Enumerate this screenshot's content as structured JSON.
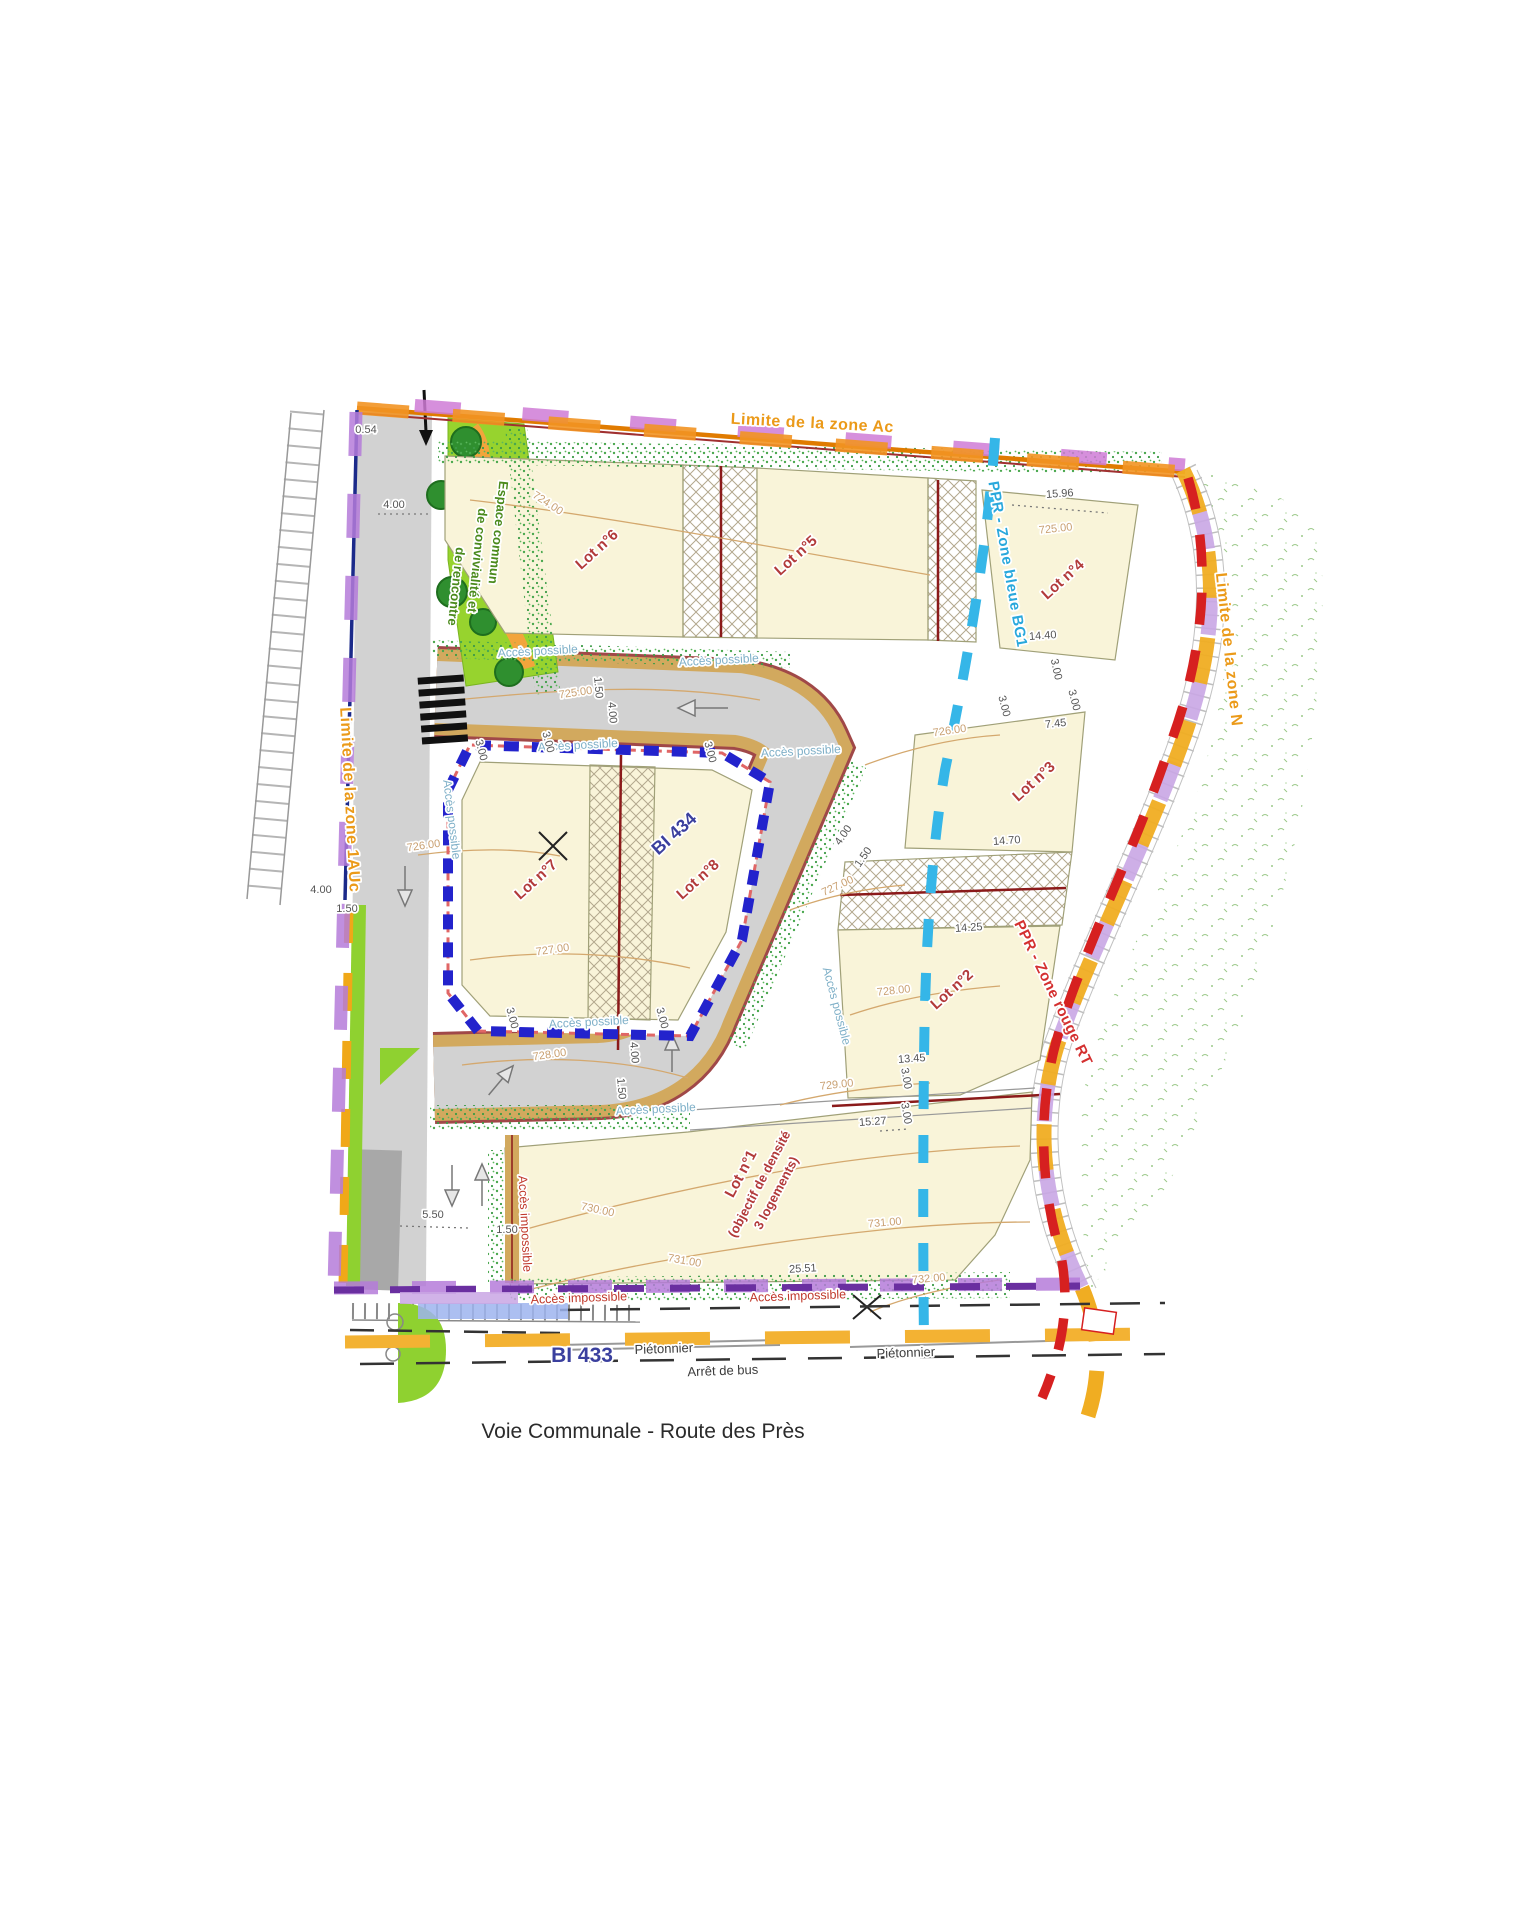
{
  "title": "Voie Communale - Route des Près",
  "colors": {
    "zone_ac_orange": "#f08c00",
    "zone_violet": "#cf7bd6",
    "zone_n_gold": "#f0ad22",
    "zone_lavender": "#c9a6e4",
    "ppr_blue": "#35b6e8",
    "ppr_red": "#d62020",
    "bi434_blue": "#2323cc",
    "lot_fill": "#f9f4d9",
    "road_gray": "#d2d2d2",
    "road_edge_tan": "#d2a95e",
    "green_space": "#97d32e"
  },
  "labels": {
    "groups": [
      {
        "name": "zone-boundaries",
        "cls": "lbl-zone",
        "size": 16,
        "color": "#eb9a19",
        "items": [
          {
            "id": "zone-ac-label",
            "t": "Limite de la zone Ac",
            "x": 812,
            "y": 428,
            "r": 3
          },
          {
            "id": "zone-n-label",
            "t": "Limite de la zone N",
            "x": 1224,
            "y": 650,
            "r": 84
          },
          {
            "id": "zone-1auc-label",
            "t": "Limite de la zone 1AUc",
            "x": 345,
            "y": 800,
            "r": 87
          }
        ]
      },
      {
        "name": "ppr-zones",
        "cls": "lbl-zone",
        "size": 15,
        "color": "#29a8dc",
        "items": [
          {
            "id": "ppr-bleue-label",
            "t": "PPR - Zone bleue BG1",
            "x": 1003,
            "y": 565,
            "r": 80
          }
        ]
      },
      {
        "name": "ppr-zones-red",
        "cls": "lbl-zone",
        "size": 15,
        "color": "#d43030",
        "items": [
          {
            "id": "ppr-rouge-label",
            "t": "PPR - Zone rouge RT",
            "x": 1049,
            "y": 995,
            "r": 64
          }
        ]
      },
      {
        "name": "lot-labels",
        "cls": "lbl-lot",
        "size": 15,
        "color": "#b23a3a",
        "items": [
          {
            "id": "lot-6",
            "t": "Lot n°6",
            "x": 600,
            "y": 553,
            "r": -42
          },
          {
            "id": "lot-5",
            "t": "Lot n°5",
            "x": 799,
            "y": 559,
            "r": -42
          },
          {
            "id": "lot-4",
            "t": "Lot n°4",
            "x": 1066,
            "y": 583,
            "r": -42
          },
          {
            "id": "lot-3",
            "t": "Lot n°3",
            "x": 1037,
            "y": 785,
            "r": -42
          },
          {
            "id": "lot-2",
            "t": "Lot n°2",
            "x": 955,
            "y": 993,
            "r": -42
          },
          {
            "id": "lot-7",
            "t": "Lot n°7",
            "x": 539,
            "y": 883,
            "r": -42
          },
          {
            "id": "lot-8",
            "t": "Lot n°8",
            "x": 701,
            "y": 883,
            "r": -42
          },
          {
            "id": "lot-1",
            "t": "Lot n°1",
            "x": 745,
            "y": 1176,
            "r": -62
          }
        ]
      },
      {
        "name": "lot-1-note",
        "cls": "lbl-lot",
        "size": 13,
        "color": "#b23a3a",
        "items": [
          {
            "id": "lot-1-note-line1",
            "t": "(objectif de densité",
            "x": 763,
            "y": 1186,
            "r": -62
          },
          {
            "id": "lot-1-note-line2",
            "t": "3 logements)",
            "x": 780,
            "y": 1195,
            "r": -62
          }
        ]
      },
      {
        "name": "bi-parcels",
        "cls": "lbl-bi",
        "size": 18,
        "color": "#3a3f9e",
        "items": [
          {
            "id": "bi-434",
            "t": "BI 434",
            "x": 678,
            "y": 838,
            "r": -42
          }
        ]
      },
      {
        "name": "bi-433-parcel",
        "cls": "lbl-bi",
        "size": 21,
        "color": "#3a3f9e",
        "items": [
          {
            "id": "bi-433",
            "t": "BI 433",
            "x": 582,
            "y": 1362,
            "r": 0
          }
        ]
      },
      {
        "name": "access-possible",
        "cls": "lbl-acc",
        "size": 12,
        "color": "#7fb0c8",
        "items": [
          {
            "id": "acces-possible-1",
            "t": "Accès possible",
            "x": 538,
            "y": 655,
            "r": -3
          },
          {
            "id": "acces-possible-2",
            "t": "Accès possible",
            "x": 719,
            "y": 664,
            "r": -3
          },
          {
            "id": "acces-possible-3",
            "t": "Accès possible",
            "x": 578,
            "y": 749,
            "r": -3
          },
          {
            "id": "acces-possible-4",
            "t": "Accès possible",
            "x": 801,
            "y": 755,
            "r": -3
          },
          {
            "id": "acces-possible-5",
            "t": "Accès possible",
            "x": 448,
            "y": 820,
            "r": 83
          },
          {
            "id": "acces-possible-6",
            "t": "Accès possible",
            "x": 589,
            "y": 1026,
            "r": -3
          },
          {
            "id": "acces-possible-7",
            "t": "Accès possible",
            "x": 656,
            "y": 1113,
            "r": -3
          },
          {
            "id": "acces-possible-8",
            "t": "Accès possible",
            "x": 833,
            "y": 1007,
            "r": 75
          }
        ]
      },
      {
        "name": "access-impossible",
        "cls": "lbl-acc",
        "size": 12.5,
        "color": "#c0392b",
        "items": [
          {
            "id": "acces-impossible-1",
            "t": "Accès impossible",
            "x": 521,
            "y": 1224,
            "r": 87
          },
          {
            "id": "acces-impossible-2",
            "t": "Accès impossible",
            "x": 579,
            "y": 1302,
            "r": -2
          },
          {
            "id": "acces-impossible-3",
            "t": "Accès impossible",
            "x": 798,
            "y": 1300,
            "r": -2
          }
        ]
      },
      {
        "name": "green-space-label",
        "cls": "lbl-esp",
        "size": 13,
        "color": "#4a8a1c",
        "items": [
          {
            "id": "espace-commun-line1",
            "t": "Espace commun",
            "x": 494,
            "y": 532,
            "r": 96
          },
          {
            "id": "espace-commun-line2",
            "t": "de convivialité et",
            "x": 473,
            "y": 560,
            "r": 96
          },
          {
            "id": "espace-commun-line3",
            "t": "de rencontre",
            "x": 452,
            "y": 586,
            "r": 96
          }
        ]
      },
      {
        "name": "street-labels",
        "cls": "lbl-street",
        "size": 13,
        "color": "#3c3c3c",
        "items": [
          {
            "id": "pietonnier-left",
            "t": "Piétonnier",
            "x": 664,
            "y": 1353,
            "r": -2
          },
          {
            "id": "pietonnier-right",
            "t": "Piétonnier",
            "x": 906,
            "y": 1357,
            "r": -2
          },
          {
            "id": "arret-de-bus",
            "t": "Arrêt de bus",
            "x": 723,
            "y": 1375,
            "r": -2
          }
        ]
      },
      {
        "name": "dimensions",
        "cls": "lbl-dim",
        "size": 11,
        "color": "#555555",
        "items": [
          {
            "id": "dim-0-54",
            "t": "0.54",
            "x": 366,
            "y": 433,
            "r": 0
          },
          {
            "id": "dim-4-00-a",
            "t": "4.00",
            "x": 394,
            "y": 508,
            "r": 0
          },
          {
            "id": "dim-4-00-b",
            "t": "4.00",
            "x": 321,
            "y": 893,
            "r": 0
          },
          {
            "id": "dim-1-50-b",
            "t": "1.50",
            "x": 347,
            "y": 912,
            "r": 0
          },
          {
            "id": "dim-5-50",
            "t": "5.50",
            "x": 433,
            "y": 1218,
            "r": 0
          },
          {
            "id": "dim-1-50-e",
            "t": "1.50",
            "x": 507,
            "y": 1233,
            "r": 0
          },
          {
            "id": "dim-15-96",
            "t": "15.96",
            "x": 1060,
            "y": 497,
            "r": -4
          },
          {
            "id": "dim-14-40",
            "t": "14.40",
            "x": 1043,
            "y": 639,
            "r": -4
          },
          {
            "id": "dim-3-00-a",
            "t": "3.00",
            "x": 1053,
            "y": 670,
            "r": 78
          },
          {
            "id": "dim-7-45",
            "t": "7.45",
            "x": 1056,
            "y": 727,
            "r": -6
          },
          {
            "id": "dim-3-00-b",
            "t": "3.00",
            "x": 1001,
            "y": 707,
            "r": 75
          },
          {
            "id": "dim-3-00-c",
            "t": "3.00",
            "x": 1071,
            "y": 701,
            "r": 75
          },
          {
            "id": "dim-14-70",
            "t": "14.70",
            "x": 1007,
            "y": 844,
            "r": -4
          },
          {
            "id": "dim-14-25",
            "t": "14.25",
            "x": 969,
            "y": 931,
            "r": -4
          },
          {
            "id": "dim-13-45",
            "t": "13.45",
            "x": 912,
            "y": 1062,
            "r": -4
          },
          {
            "id": "dim-3-00-d",
            "t": "3.00",
            "x": 903,
            "y": 1079,
            "r": 80
          },
          {
            "id": "dim-3-00-e",
            "t": "3.00",
            "x": 903,
            "y": 1114,
            "r": 80
          },
          {
            "id": "dim-15-27",
            "t": "15.27",
            "x": 873,
            "y": 1125,
            "r": -4
          },
          {
            "id": "dim-25-51",
            "t": "25.51",
            "x": 803,
            "y": 1272,
            "r": -3
          },
          {
            "id": "dim-3-00-f",
            "t": "3.00",
            "x": 478,
            "y": 751,
            "r": 75
          },
          {
            "id": "dim-3-00-g",
            "t": "3.00",
            "x": 545,
            "y": 743,
            "r": 75
          },
          {
            "id": "dim-3-00-h",
            "t": "3.00",
            "x": 707,
            "y": 753,
            "r": 75
          },
          {
            "id": "dim-4-00-c",
            "t": "4.00",
            "x": 846,
            "y": 837,
            "r": -55
          },
          {
            "id": "dim-1-50-c",
            "t": "1.50",
            "x": 866,
            "y": 859,
            "r": -55
          },
          {
            "id": "dim-4-00-d",
            "t": "4.00",
            "x": 631,
            "y": 1053,
            "r": 85
          },
          {
            "id": "dim-1-50-d",
            "t": "1.50",
            "x": 618,
            "y": 1089,
            "r": 85
          },
          {
            "id": "dim-4-00-e",
            "t": "4.00",
            "x": 609,
            "y": 713,
            "r": 85
          },
          {
            "id": "dim-1-50-f",
            "t": "1.50",
            "x": 595,
            "y": 688,
            "r": 85
          },
          {
            "id": "dim-3-00-i",
            "t": "3.00",
            "x": 659,
            "y": 1019,
            "r": 75
          },
          {
            "id": "dim-3-00-j",
            "t": "3.00",
            "x": 509,
            "y": 1019,
            "r": 75
          }
        ]
      },
      {
        "name": "contour-elevations",
        "cls": "lbl-ctr",
        "size": 11,
        "color": "#c9a071",
        "items": [
          {
            "id": "contour-724-00",
            "t": "724.00",
            "x": 546,
            "y": 506,
            "r": 33
          },
          {
            "id": "contour-725-00-a",
            "t": "725.00",
            "x": 576,
            "y": 696,
            "r": -8
          },
          {
            "id": "contour-725-00-b",
            "t": "725.00",
            "x": 1056,
            "y": 532,
            "r": -6
          },
          {
            "id": "contour-726-00-a",
            "t": "726.00",
            "x": 424,
            "y": 849,
            "r": -8
          },
          {
            "id": "contour-726-00-b",
            "t": "726.00",
            "x": 950,
            "y": 734,
            "r": -8
          },
          {
            "id": "contour-727-00-a",
            "t": "727.00",
            "x": 553,
            "y": 953,
            "r": -8
          },
          {
            "id": "contour-727-00-b",
            "t": "727.00",
            "x": 839,
            "y": 889,
            "r": -25
          },
          {
            "id": "contour-728-00-a",
            "t": "728.00",
            "x": 550,
            "y": 1058,
            "r": -8
          },
          {
            "id": "contour-728-00-b",
            "t": "728.00",
            "x": 894,
            "y": 994,
            "r": -6
          },
          {
            "id": "contour-729-00",
            "t": "729.00",
            "x": 837,
            "y": 1088,
            "r": -6
          },
          {
            "id": "contour-730-00",
            "t": "730.00",
            "x": 597,
            "y": 1213,
            "r": 12
          },
          {
            "id": "contour-731-00-a",
            "t": "731.00",
            "x": 684,
            "y": 1264,
            "r": 10
          },
          {
            "id": "contour-731-00-b",
            "t": "731.00",
            "x": 885,
            "y": 1226,
            "r": -5
          },
          {
            "id": "contour-732-00",
            "t": "732.00",
            "x": 929,
            "y": 1282,
            "r": -5
          }
        ]
      }
    ]
  }
}
